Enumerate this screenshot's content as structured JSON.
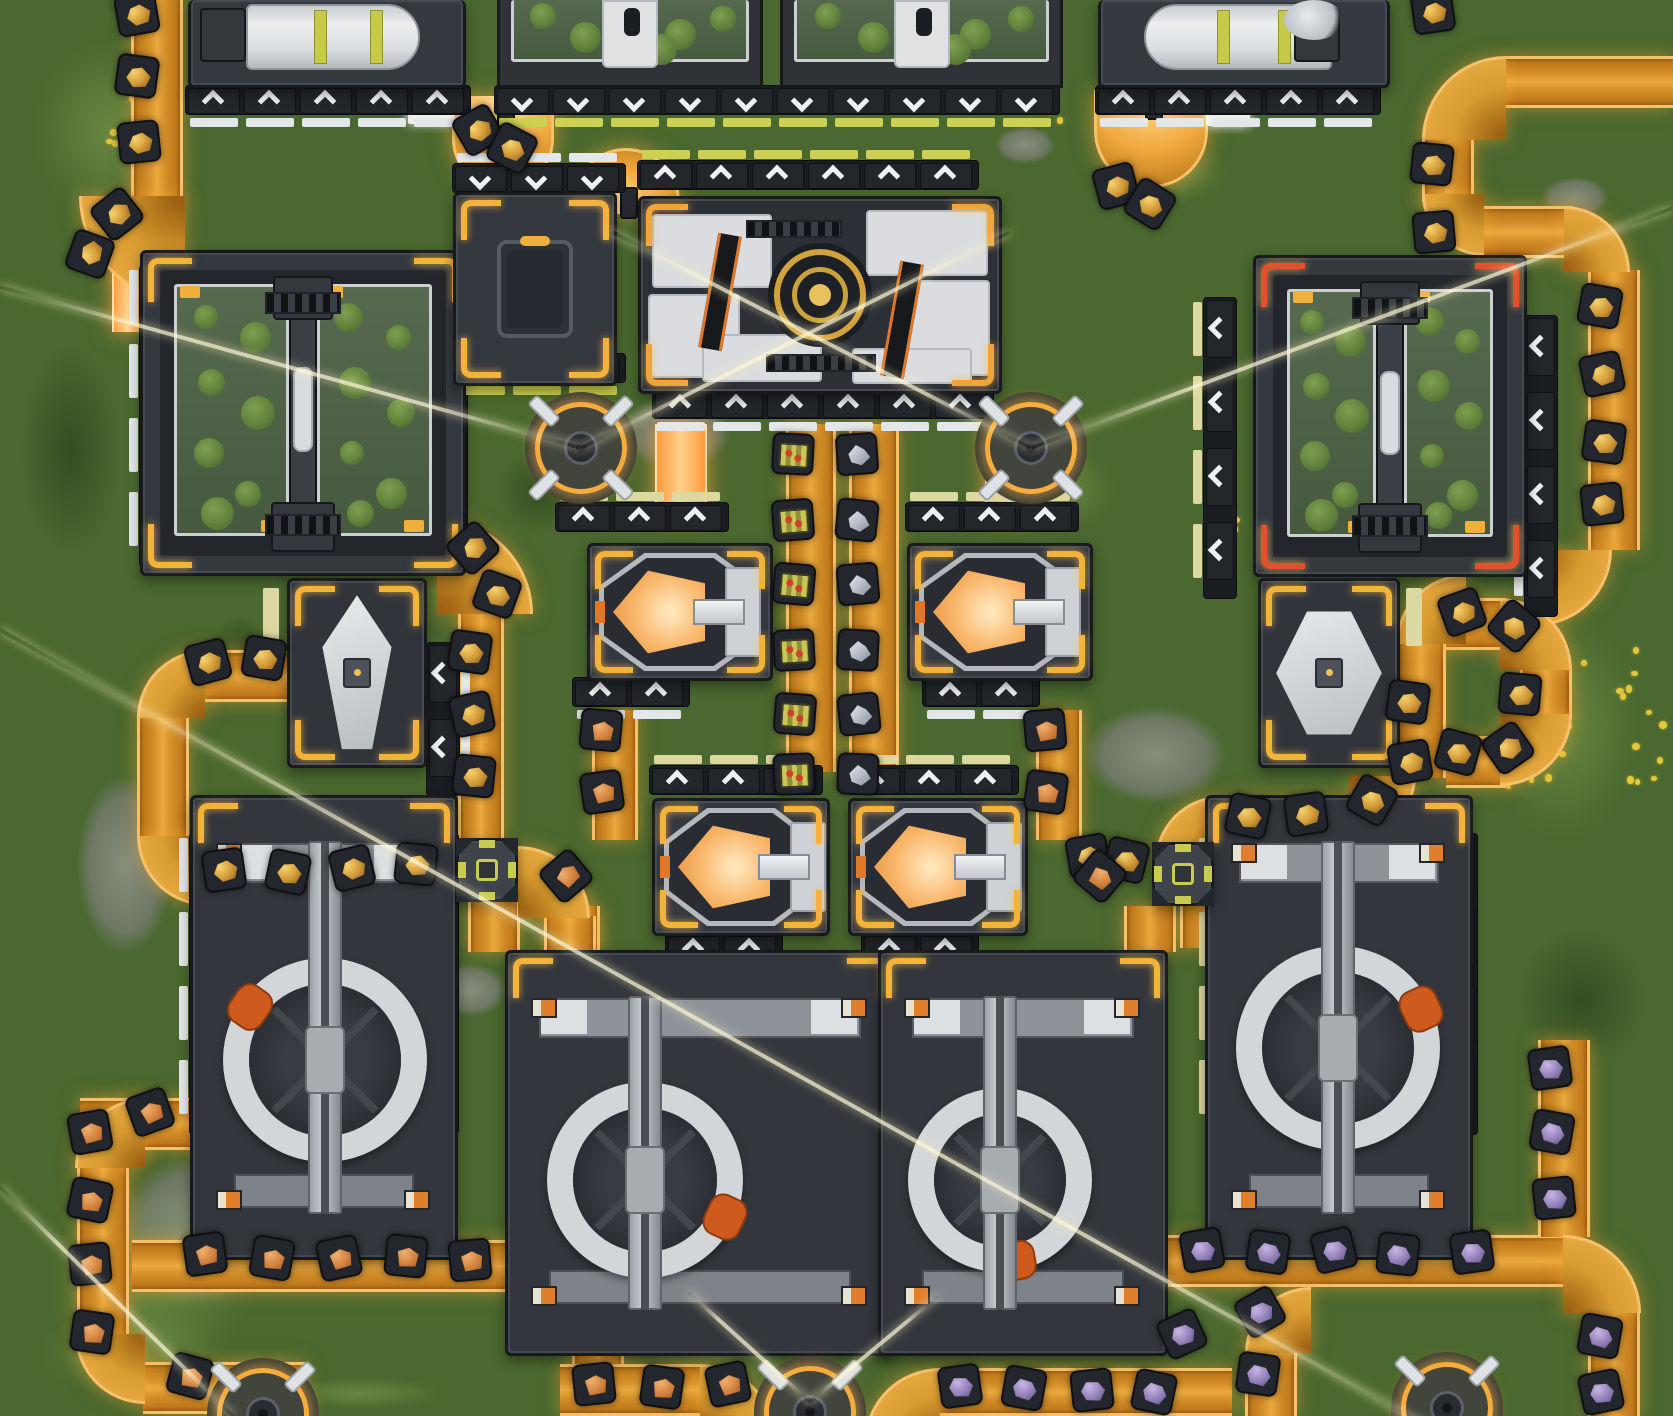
{
  "scene": {
    "width": 1673,
    "height": 1416,
    "view": "top-down-factory",
    "ground_color": "#4a682f",
    "belt_color": "#d2902a",
    "accent_yellow": "#f3b33a",
    "accent_red": "#e2502e",
    "glow_orange": "#f7c169",
    "crucible_glow": "#f8b66a",
    "wedge_orange": "#cf5a1d"
  },
  "ground": {
    "patches": [
      [
        "stone",
        600,
        385,
        150,
        95
      ],
      [
        "stone",
        1060,
        690,
        190,
        130
      ],
      [
        "stone",
        60,
        745,
        130,
        240
      ],
      [
        "stone",
        420,
        955,
        100,
        70
      ],
      [
        "stone",
        1275,
        295,
        70,
        45
      ],
      [
        "stone",
        1530,
        170,
        90,
        55
      ],
      [
        "stone",
        870,
        1160,
        110,
        90
      ],
      [
        "stone",
        95,
        1130,
        200,
        200
      ],
      [
        "stone",
        985,
        120,
        80,
        50
      ],
      [
        "stone",
        330,
        640,
        60,
        40
      ],
      [
        "light",
        0,
        0,
        220,
        260
      ],
      [
        "light",
        1450,
        560,
        223,
        330
      ],
      [
        "light",
        980,
        430,
        160,
        120
      ],
      [
        "light",
        0,
        1150,
        300,
        266
      ],
      [
        "light",
        620,
        1300,
        200,
        116
      ],
      [
        "light",
        1100,
        120,
        150,
        100
      ],
      [
        "light",
        0,
        1290,
        260,
        126
      ],
      [
        "light",
        240,
        1370,
        240,
        46
      ],
      [
        "dark",
        0,
        300,
        140,
        300
      ],
      [
        "dark",
        480,
        430,
        120,
        120
      ],
      [
        "dark",
        900,
        1050,
        260,
        200
      ],
      [
        "dark",
        1490,
        900,
        183,
        200
      ],
      [
        "dark",
        200,
        600,
        80,
        100
      ]
    ],
    "flower_clusters": [
      {
        "x": 1500,
        "y": 640,
        "w": 160,
        "h": 150,
        "n": 30
      },
      {
        "x": 95,
        "y": 90,
        "w": 70,
        "h": 60,
        "n": 8
      },
      {
        "x": 140,
        "y": 150,
        "w": 40,
        "h": 30,
        "n": 5
      },
      {
        "x": 628,
        "y": 640,
        "w": 24,
        "h": 18,
        "n": 3
      },
      {
        "x": 1205,
        "y": 512,
        "w": 30,
        "h": 24,
        "n": 4
      },
      {
        "x": 745,
        "y": 585,
        "w": 20,
        "h": 16,
        "n": 3
      },
      {
        "x": 1020,
        "y": 95,
        "w": 40,
        "h": 26,
        "n": 4
      }
    ]
  },
  "beams": [
    [
      0,
      287,
      581,
      448
    ],
    [
      581,
      448,
      1010,
      232
    ],
    [
      612,
      232,
      1031,
      448
    ],
    [
      1031,
      448,
      1673,
      208
    ],
    [
      0,
      630,
      1500,
      1467
    ],
    [
      0,
      1187,
      233,
      1416
    ],
    [
      810,
      1402,
      688,
      1292
    ],
    [
      810,
      1402,
      938,
      1296
    ]
  ],
  "belts": {
    "segments": [
      [
        "v",
        131,
        0,
        52,
        206
      ],
      [
        "inj",
        112,
        256,
        30,
        76
      ],
      [
        "h",
        1506,
        56,
        167,
        52
      ],
      [
        "v",
        1422,
        138,
        52,
        64
      ],
      [
        "h",
        1484,
        206,
        88,
        52
      ],
      [
        "v",
        1588,
        270,
        52,
        280
      ],
      [
        "h",
        1446,
        598,
        60,
        52
      ],
      [
        "v",
        1520,
        668,
        52,
        50
      ],
      [
        "h",
        1446,
        736,
        60,
        52
      ],
      [
        "v",
        1396,
        644,
        50,
        134
      ],
      [
        "h",
        1228,
        796,
        128,
        52
      ],
      [
        "v",
        786,
        424,
        50,
        348
      ],
      [
        "v",
        849,
        424,
        50,
        348
      ],
      [
        "inj",
        655,
        424,
        52,
        92
      ],
      [
        "inj",
        985,
        424,
        52,
        92
      ],
      [
        "v",
        592,
        710,
        46,
        130
      ],
      [
        "v",
        548,
        906,
        52,
        46
      ],
      [
        "v",
        1036,
        710,
        46,
        130
      ],
      [
        "v",
        1124,
        906,
        52,
        46
      ],
      [
        "v",
        458,
        612,
        46,
        228
      ],
      [
        "h",
        194,
        650,
        96,
        52
      ],
      [
        "v",
        137,
        716,
        52,
        120
      ],
      [
        "h",
        204,
        856,
        226,
        52
      ],
      [
        "v",
        468,
        900,
        52,
        52
      ],
      [
        "v",
        544,
        916,
        52,
        36
      ],
      [
        "h",
        80,
        1098,
        120,
        52
      ],
      [
        "v",
        77,
        1166,
        52,
        170
      ],
      [
        "h",
        143,
        1362,
        162,
        52
      ],
      [
        "h",
        132,
        1240,
        422,
        52
      ],
      [
        "inj",
        197,
        1094,
        26,
        64
      ],
      [
        "v",
        572,
        1304,
        52,
        60
      ],
      [
        "h",
        560,
        1364,
        142,
        52
      ],
      [
        "h",
        940,
        1368,
        292,
        48
      ],
      [
        "h",
        1165,
        1235,
        398,
        52
      ],
      [
        "v",
        1588,
        1313,
        52,
        103
      ],
      [
        "v",
        1245,
        1351,
        52,
        65
      ],
      [
        "v",
        1538,
        1040,
        52,
        197
      ],
      [
        "v",
        1180,
        904,
        52,
        44
      ],
      [
        "v",
        1232,
        908,
        52,
        40
      ]
    ],
    "curves": [
      [
        "bl",
        79,
        196,
        106
      ],
      [
        "tl",
        1422,
        56,
        84
      ],
      [
        "bl",
        1422,
        194,
        62
      ],
      [
        "tr",
        1564,
        206,
        66
      ],
      [
        "br",
        1536,
        550,
        76
      ],
      [
        "tl",
        1396,
        574,
        70
      ],
      [
        "tr",
        1500,
        598,
        72
      ],
      [
        "br",
        1500,
        714,
        72
      ],
      [
        "br",
        1350,
        776,
        66
      ],
      [
        "tl",
        1155,
        796,
        66
      ],
      [
        "tr",
        437,
        518,
        96
      ],
      [
        "tl",
        137,
        650,
        68
      ],
      [
        "bl",
        137,
        836,
        70
      ],
      [
        "tr",
        518,
        846,
        72
      ],
      [
        "tl",
        75,
        1098,
        70
      ],
      [
        "bl",
        75,
        1334,
        70
      ],
      [
        "tr",
        552,
        1240,
        70
      ],
      [
        "tr",
        700,
        1364,
        76
      ],
      [
        "tl",
        864,
        1368,
        76
      ],
      [
        "tr",
        1563,
        1235,
        78
      ],
      [
        "tl",
        1245,
        1287,
        66
      ],
      [
        "tr",
        1212,
        846,
        70
      ]
    ],
    "uturns": [
      {
        "x": 452,
        "y": 96,
        "w": 102,
        "h": 94,
        "open": "up"
      },
      {
        "x": 572,
        "y": 148,
        "w": 108,
        "h": 66,
        "open": "down"
      },
      {
        "x": 1094,
        "y": 90,
        "w": 114,
        "h": 98,
        "open": "up"
      }
    ],
    "stripes": [
      [
        408,
        110,
        46,
        14
      ],
      [
        536,
        190,
        38,
        13
      ],
      [
        1206,
        112,
        44,
        14
      ]
    ]
  },
  "items": {
    "gold": [
      [
        137,
        14,
        -10
      ],
      [
        137,
        76,
        8
      ],
      [
        139,
        142,
        -6
      ],
      [
        117,
        214,
        -38
      ],
      [
        90,
        254,
        -70
      ],
      [
        478,
        130,
        -30
      ],
      [
        512,
        148,
        28
      ],
      [
        1116,
        186,
        -15
      ],
      [
        1150,
        204,
        32
      ],
      [
        1433,
        12,
        -8
      ],
      [
        1432,
        164,
        6
      ],
      [
        1434,
        232,
        -5
      ],
      [
        1600,
        306,
        10
      ],
      [
        1602,
        374,
        -12
      ],
      [
        1604,
        442,
        8
      ],
      [
        1602,
        504,
        -6
      ],
      [
        1462,
        612,
        -20
      ],
      [
        1514,
        626,
        40
      ],
      [
        1520,
        694,
        5
      ],
      [
        1508,
        748,
        -35
      ],
      [
        1458,
        752,
        15
      ],
      [
        1408,
        702,
        8
      ],
      [
        1410,
        762,
        -10
      ],
      [
        1372,
        800,
        30
      ],
      [
        1306,
        814,
        -8
      ],
      [
        1248,
        816,
        12
      ],
      [
        473,
        548,
        -42
      ],
      [
        497,
        594,
        20
      ],
      [
        470,
        652,
        8
      ],
      [
        472,
        714,
        -12
      ],
      [
        474,
        776,
        6
      ],
      [
        208,
        662,
        -15
      ],
      [
        264,
        658,
        10
      ],
      [
        224,
        870,
        -8
      ],
      [
        288,
        872,
        12
      ],
      [
        352,
        868,
        -14
      ],
      [
        416,
        864,
        6
      ],
      [
        1088,
        856,
        -10
      ],
      [
        1126,
        860,
        14
      ]
    ],
    "tray": [
      [
        793,
        454,
        3
      ],
      [
        793,
        520,
        -4
      ],
      [
        794,
        584,
        5
      ],
      [
        794,
        650,
        -3
      ],
      [
        795,
        714,
        4
      ],
      [
        794,
        774,
        -2
      ]
    ],
    "crystal": [
      [
        857,
        454,
        -4
      ],
      [
        857,
        520,
        6
      ],
      [
        858,
        584,
        -5
      ],
      [
        858,
        650,
        3
      ],
      [
        859,
        714,
        -6
      ],
      [
        858,
        774,
        2
      ]
    ],
    "copper": [
      [
        601,
        730,
        5
      ],
      [
        602,
        792,
        -8
      ],
      [
        566,
        876,
        -40
      ],
      [
        1045,
        730,
        -5
      ],
      [
        1046,
        792,
        8
      ],
      [
        1100,
        876,
        40
      ],
      [
        205,
        1254,
        -8
      ],
      [
        272,
        1258,
        10
      ],
      [
        339,
        1258,
        -12
      ],
      [
        406,
        1256,
        6
      ],
      [
        470,
        1260,
        -5
      ],
      [
        90,
        1132,
        -10
      ],
      [
        90,
        1200,
        12
      ],
      [
        90,
        1264,
        -6
      ],
      [
        92,
        1332,
        8
      ],
      [
        150,
        1112,
        -20
      ],
      [
        190,
        1376,
        15
      ],
      [
        594,
        1384,
        -6
      ],
      [
        662,
        1387,
        8
      ],
      [
        728,
        1384,
        -12
      ]
    ],
    "purple": [
      [
        960,
        1386,
        -8
      ],
      [
        1024,
        1388,
        10
      ],
      [
        1092,
        1390,
        -6
      ],
      [
        1154,
        1392,
        12
      ],
      [
        1202,
        1250,
        -10
      ],
      [
        1268,
        1252,
        8
      ],
      [
        1334,
        1250,
        -14
      ],
      [
        1398,
        1254,
        6
      ],
      [
        1472,
        1252,
        -8
      ],
      [
        1600,
        1336,
        10
      ],
      [
        1601,
        1392,
        -12
      ],
      [
        1260,
        1312,
        -30
      ],
      [
        1258,
        1374,
        8
      ],
      [
        1182,
        1334,
        -25
      ],
      [
        1550,
        1068,
        -8
      ],
      [
        1552,
        1132,
        10
      ],
      [
        1554,
        1198,
        -6
      ]
    ]
  },
  "ports": [
    [
      188,
      88,
      5,
      "up",
      "h",
      "white",
      "after"
    ],
    [
      497,
      88,
      10,
      "down",
      "h",
      "yellow",
      "after"
    ],
    [
      1098,
      88,
      5,
      "up",
      "h",
      "white",
      "after"
    ],
    [
      142,
      268,
      4,
      "right",
      "v",
      "white",
      "before"
    ],
    [
      437,
      270,
      4,
      "right",
      "v",
      "cream",
      "before"
    ],
    [
      1206,
      300,
      4,
      "left",
      "v",
      "cream",
      "before"
    ],
    [
      1527,
      318,
      4,
      "left",
      "v",
      "white",
      "before"
    ],
    [
      455,
      166,
      3,
      "down",
      "h",
      "white",
      "before"
    ],
    [
      455,
      356,
      3,
      "down",
      "h",
      "yellow",
      "after"
    ],
    [
      640,
      163,
      6,
      "up",
      "h",
      "yellow",
      "before"
    ],
    [
      655,
      392,
      6,
      "up",
      "h",
      "white",
      "after"
    ],
    [
      558,
      505,
      3,
      "up",
      "h",
      "cream",
      "before"
    ],
    [
      575,
      680,
      2,
      "up",
      "h",
      "white",
      "after"
    ],
    [
      908,
      505,
      3,
      "up",
      "h",
      "cream",
      "before"
    ],
    [
      925,
      680,
      2,
      "up",
      "h",
      "white",
      "after"
    ],
    [
      652,
      768,
      3,
      "up",
      "h",
      "cream",
      "before"
    ],
    [
      668,
      936,
      2,
      "up",
      "h",
      "white",
      "after"
    ],
    [
      848,
      768,
      3,
      "up",
      "h",
      "cream",
      "before"
    ],
    [
      864,
      936,
      2,
      "up",
      "h",
      "white",
      "after"
    ],
    [
      192,
      836,
      4,
      "right",
      "v",
      "white",
      "before"
    ],
    [
      428,
      836,
      4,
      "right",
      "v",
      "cream",
      "before"
    ],
    [
      518,
      988,
      3,
      "right",
      "v",
      "white",
      "before"
    ],
    [
      852,
      988,
      4,
      "right",
      "v",
      "cream",
      "before"
    ],
    [
      880,
      988,
      4,
      "right",
      "v",
      "white",
      "before"
    ],
    [
      1136,
      988,
      4,
      "left",
      "v",
      "cream",
      "before"
    ],
    [
      1212,
      836,
      4,
      "left",
      "v",
      "cream",
      "before"
    ],
    [
      1447,
      836,
      4,
      "left",
      "v",
      "white",
      "before"
    ],
    [
      429,
      645,
      2,
      "left",
      "v",
      "white",
      "after"
    ]
  ],
  "machines": [
    {
      "type": "topcyl",
      "x": 188,
      "y": 0,
      "w": 278,
      "h": 88,
      "flip": false
    },
    {
      "type": "topgreen",
      "x": 497,
      "y": 0,
      "w": 266,
      "h": 88
    },
    {
      "type": "topgreen",
      "x": 780,
      "y": 0,
      "w": 283,
      "h": 88
    },
    {
      "type": "topcyl",
      "x": 1098,
      "y": 0,
      "w": 292,
      "h": 88,
      "flip": true
    },
    {
      "type": "greenhouse",
      "x": 140,
      "y": 250,
      "w": 326,
      "h": 326,
      "accent": "#f3b33a"
    },
    {
      "type": "greenhouse",
      "x": 1253,
      "y": 255,
      "w": 274,
      "h": 322,
      "accent": "#e2502e"
    },
    {
      "type": "container",
      "x": 453,
      "y": 192,
      "w": 164,
      "h": 194
    },
    {
      "type": "assembler",
      "x": 638,
      "y": 196,
      "w": 364,
      "h": 198
    },
    {
      "type": "smelter",
      "x": 587,
      "y": 543,
      "w": 186,
      "h": 138
    },
    {
      "type": "smelter",
      "x": 907,
      "y": 543,
      "w": 186,
      "h": 138
    },
    {
      "type": "smelter",
      "x": 652,
      "y": 798,
      "w": 178,
      "h": 138
    },
    {
      "type": "smelter",
      "x": 848,
      "y": 798,
      "w": 180,
      "h": 138
    },
    {
      "type": "diamond",
      "x": 287,
      "y": 578,
      "w": 140,
      "h": 190,
      "rot": "v"
    },
    {
      "type": "diamond",
      "x": 1258,
      "y": 578,
      "w": 142,
      "h": 190,
      "rot": "h"
    },
    {
      "type": "mixer",
      "x": 190,
      "y": 795,
      "w": 268,
      "h": 465,
      "cx": 325,
      "cy": 1060,
      "R": 102,
      "wedge": 215
    },
    {
      "type": "mixer",
      "x": 505,
      "y": 950,
      "w": 390,
      "h": 406,
      "cx": 645,
      "cy": 1180,
      "R": 98,
      "wedge": 25
    },
    {
      "type": "mixer",
      "x": 878,
      "y": 950,
      "w": 290,
      "h": 406,
      "cx": 1000,
      "cy": 1180,
      "R": 92,
      "wedge": 80
    },
    {
      "type": "mixer",
      "x": 1205,
      "y": 795,
      "w": 268,
      "h": 465,
      "cx": 1338,
      "cy": 1048,
      "R": 102,
      "wedge": 335
    },
    {
      "type": "splitter",
      "x": 456,
      "y": 838,
      "w": 62,
      "h": 64
    },
    {
      "type": "splitter",
      "x": 1152,
      "y": 842,
      "w": 62,
      "h": 64
    }
  ],
  "turrets": [
    {
      "x": 581,
      "y": 448
    },
    {
      "x": 1031,
      "y": 448
    },
    {
      "x": 810,
      "y": 1412
    },
    {
      "x": 263,
      "y": 1414
    },
    {
      "x": 1447,
      "y": 1408
    }
  ]
}
